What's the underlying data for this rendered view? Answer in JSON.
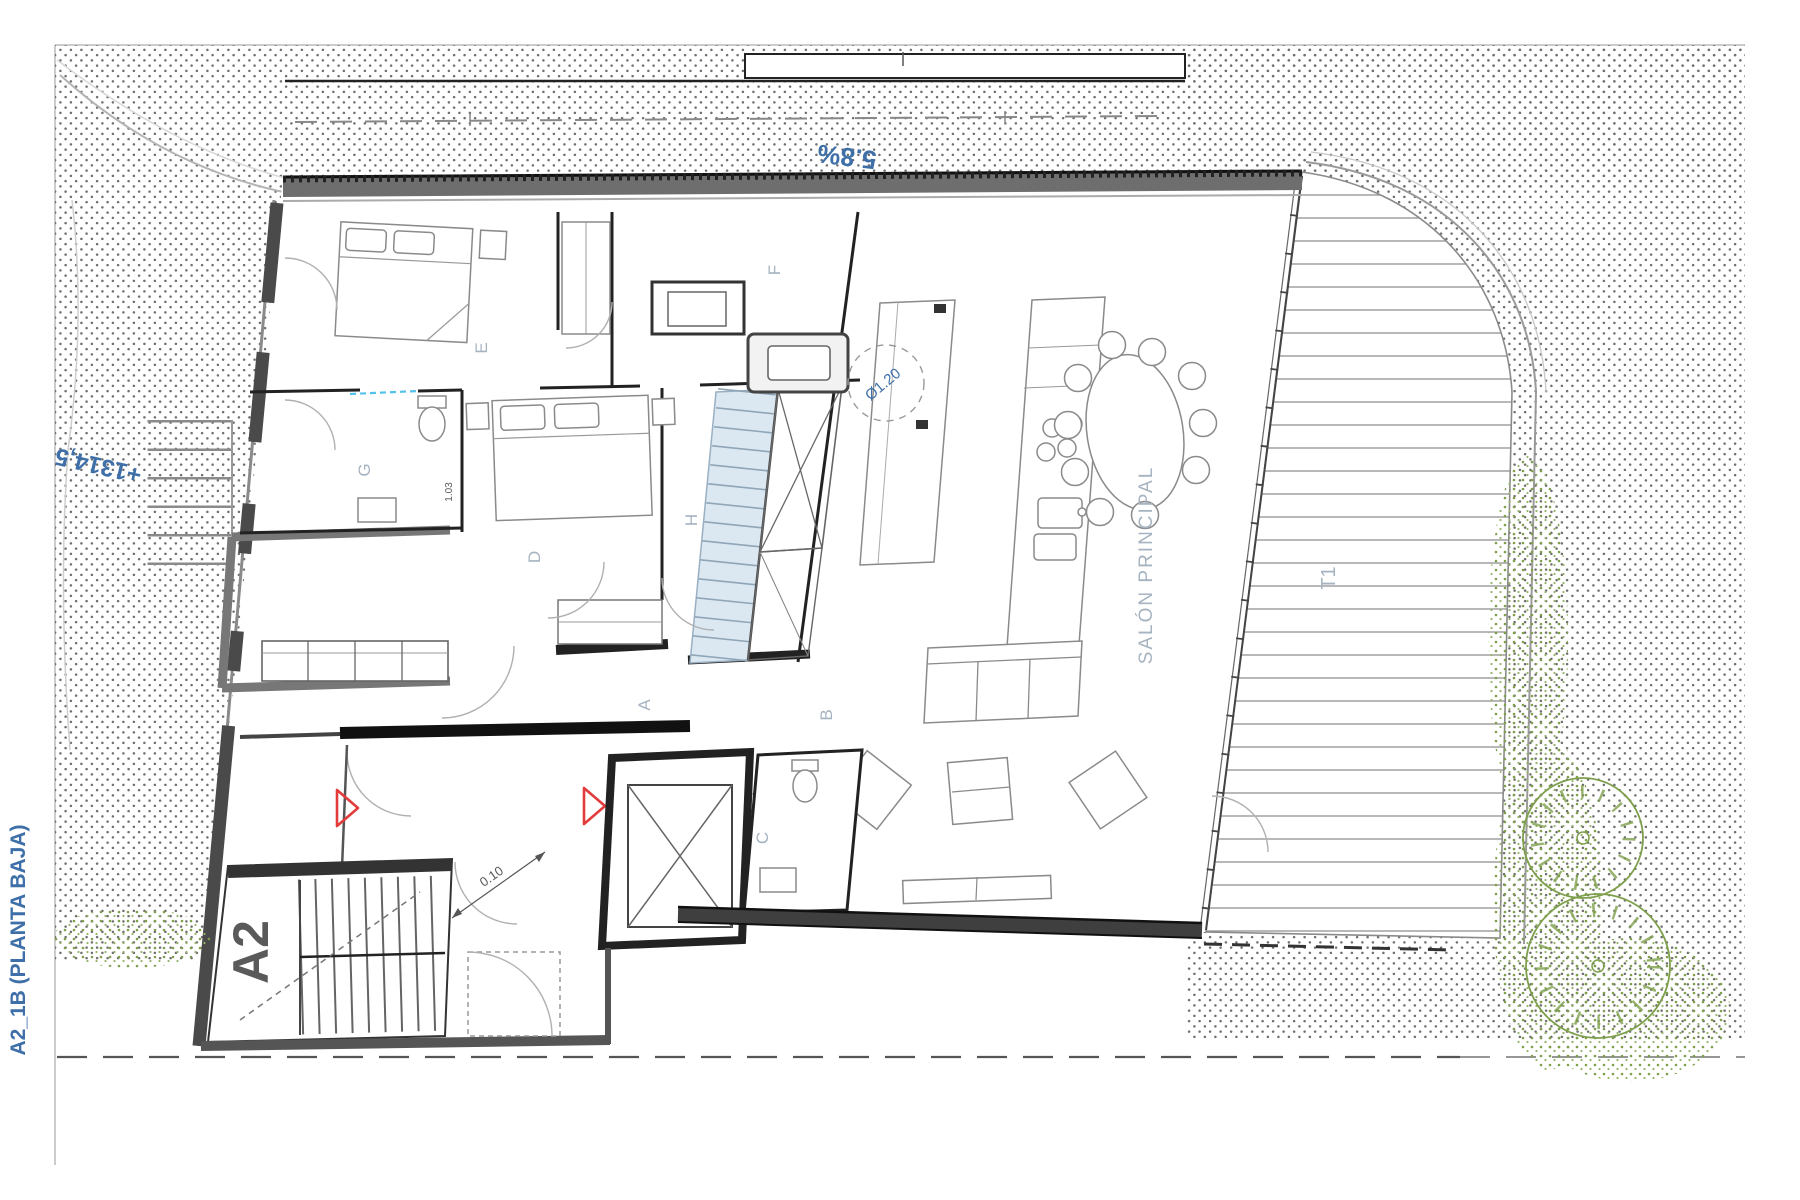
{
  "sheet": {
    "label": "A2_1B (PLANTA BAJA)"
  },
  "site": {
    "slope": "5.8%",
    "elevation": "+1314,5"
  },
  "plan": {
    "core": "A2",
    "terrace": "T1",
    "salon": "SALÓN PRINCIPAL",
    "rooms": {
      "a": "A",
      "b": "B",
      "c": "C",
      "d": "D",
      "e": "E",
      "f": "F",
      "g": "G",
      "h": "H"
    },
    "dims": {
      "circle": "Ø1.20",
      "step": "0.10",
      "small": "1.03"
    }
  },
  "colors": {
    "blue_text": "#3e6fa8",
    "label": "#a6b3c0",
    "red": "#e23b3b",
    "green": "#7ea04c",
    "stair_blue": "#dbe7f1"
  }
}
